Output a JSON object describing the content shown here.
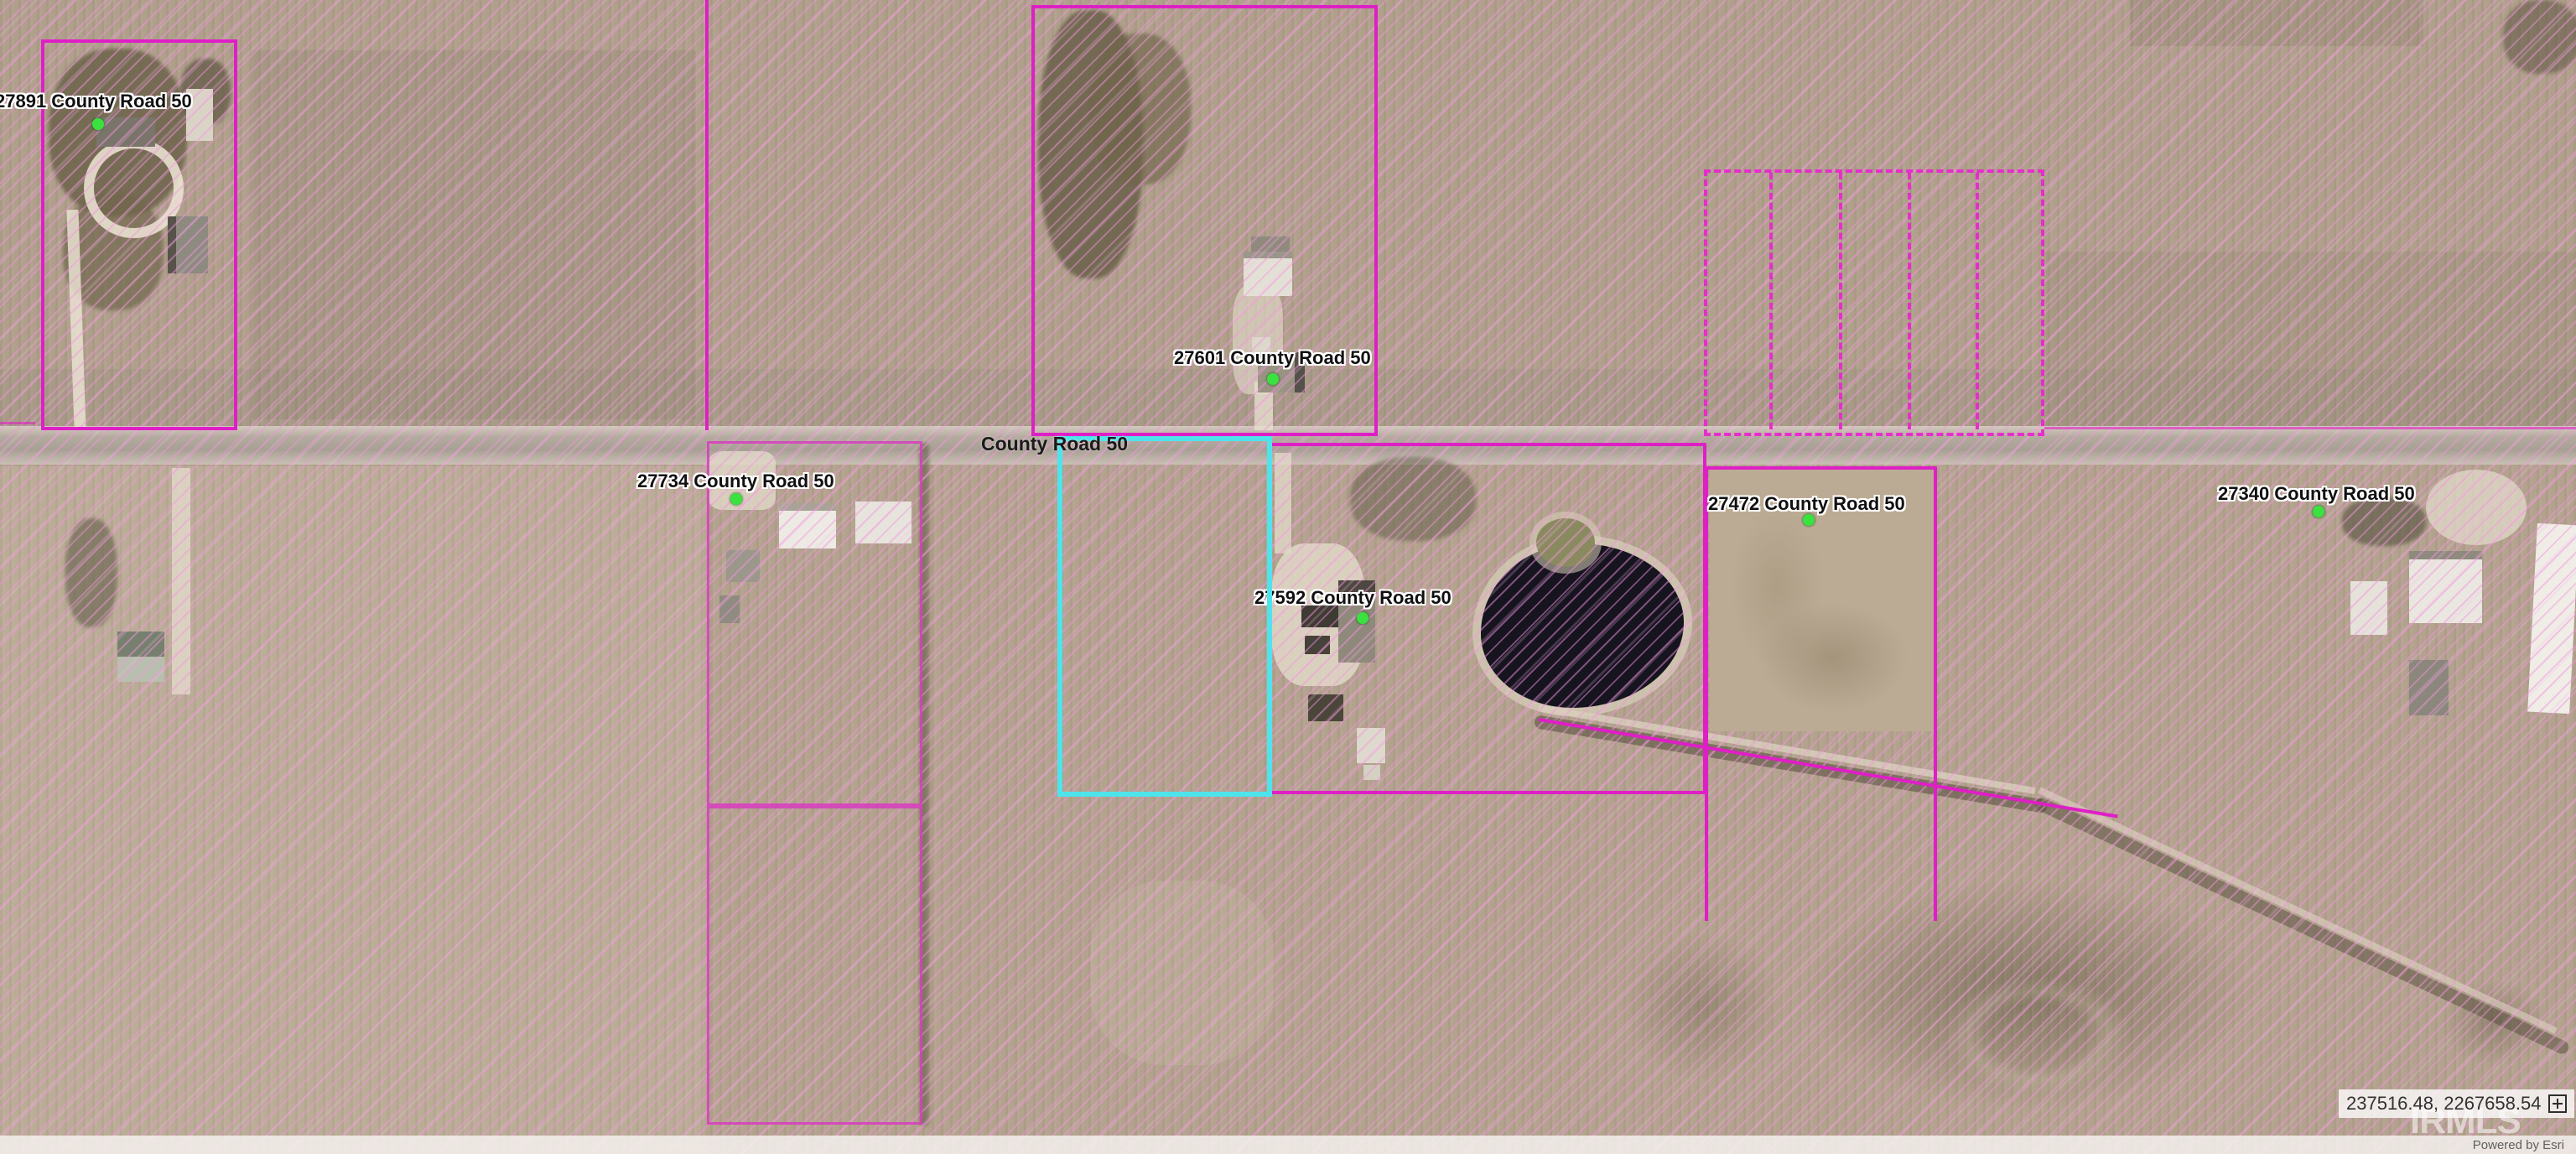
{
  "map": {
    "road": {
      "label": "County Road 50"
    },
    "address_labels": [
      {
        "text": "27891 County Road 50"
      },
      {
        "text": "27601 County Road 50"
      },
      {
        "text": "27734 County Road 50"
      },
      {
        "text": "27592 County Road 50"
      },
      {
        "text": "27472 County Road 50"
      },
      {
        "text": "27340 County Road 50"
      }
    ],
    "colors": {
      "parcel_line": "#df1fc6",
      "parcel_hatch": "#f692e0",
      "selected_parcel": "#4ee4ec",
      "marker": "#39e23e",
      "water": "#15141f"
    }
  },
  "widgets": {
    "coordinates": {
      "value": "237516.48, 2267658.54",
      "icon": "plus-box-icon"
    },
    "watermark": "IRMLS",
    "attribution": "Powered by Esri"
  }
}
